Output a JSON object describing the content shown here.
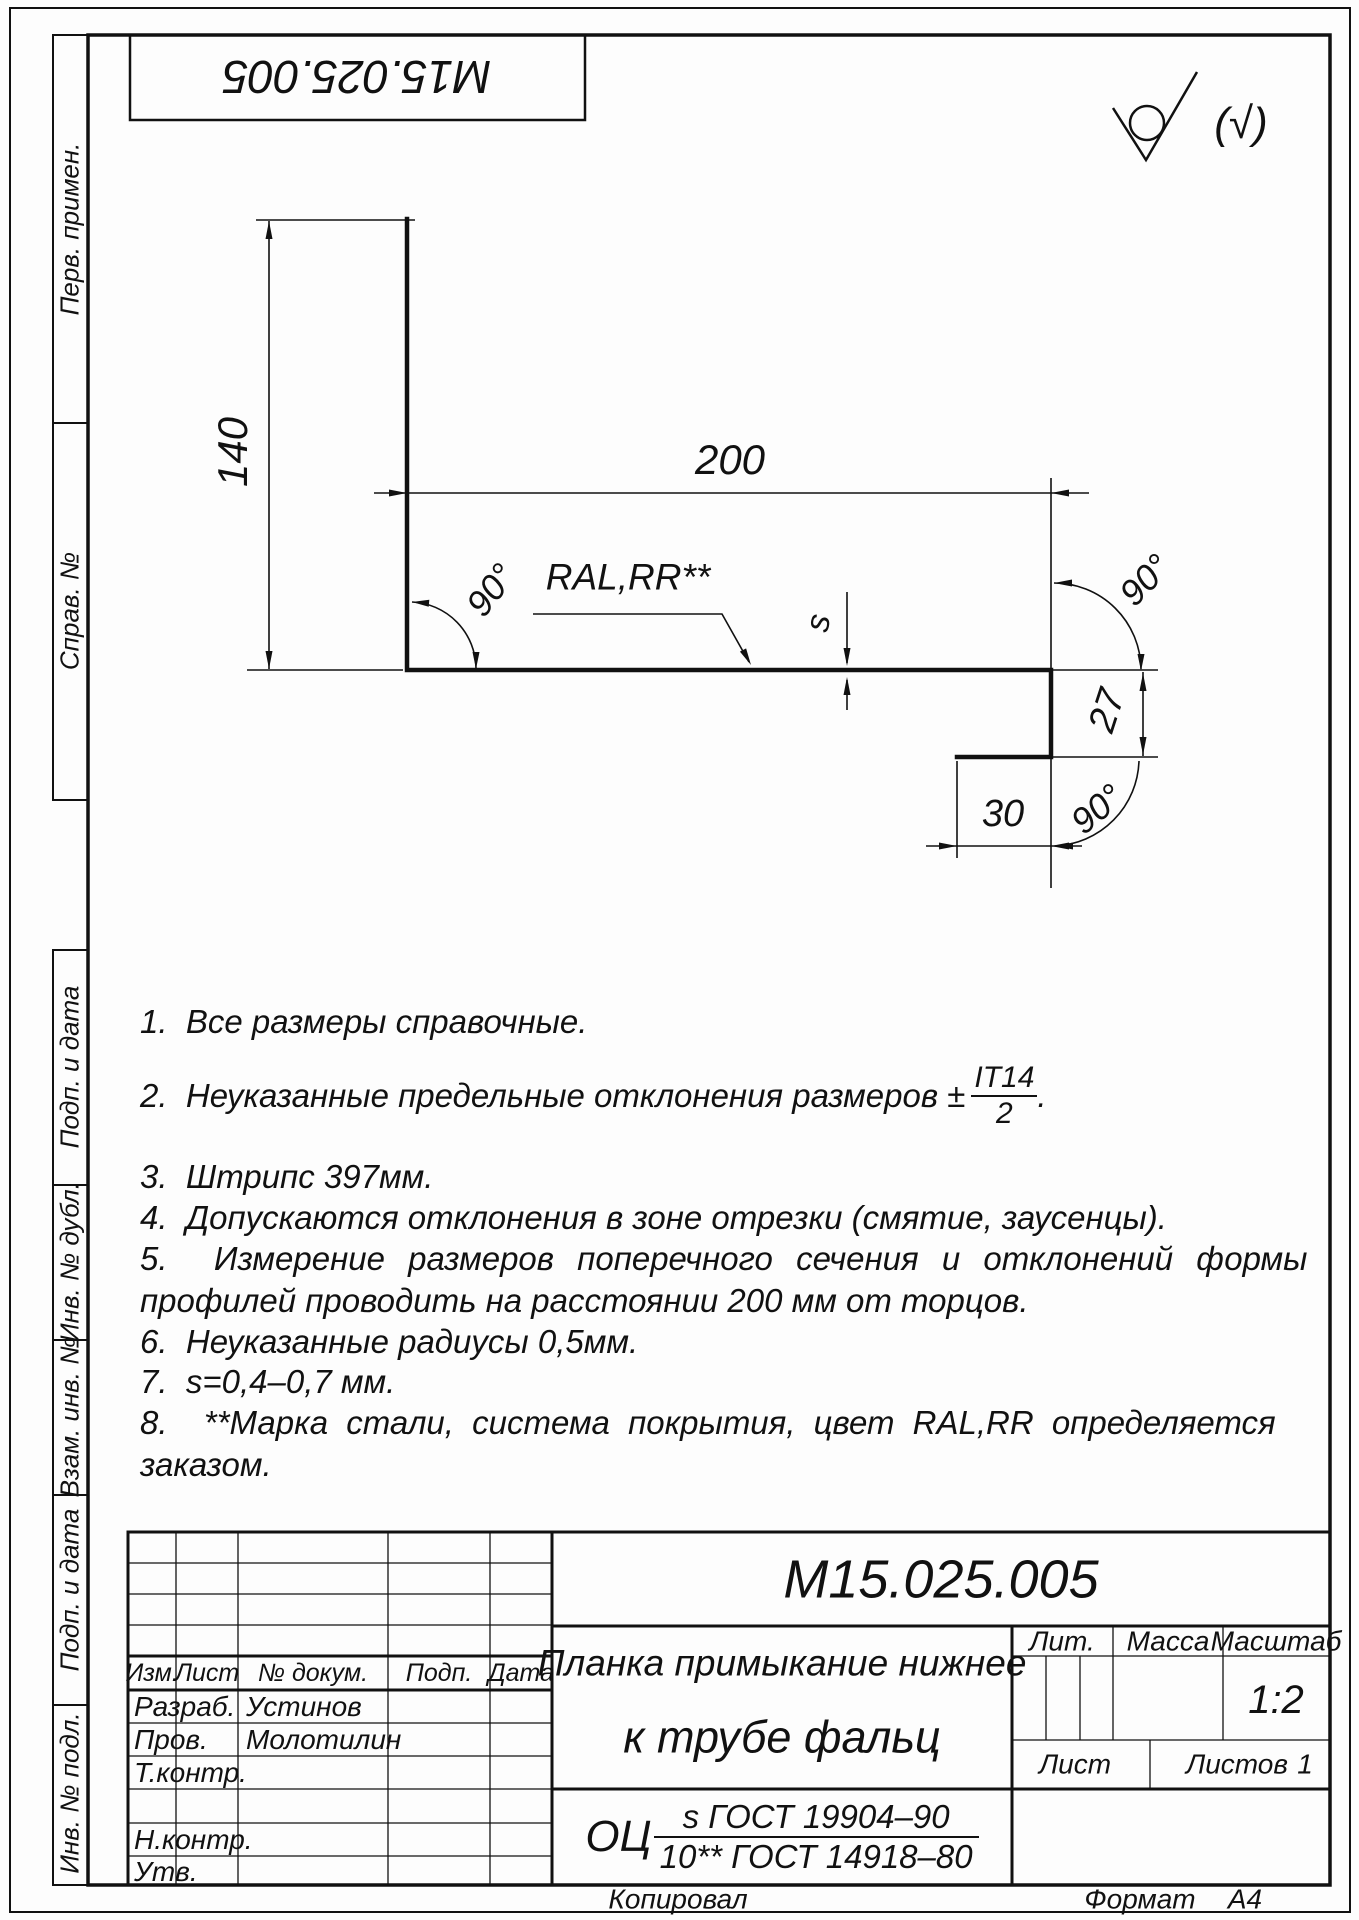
{
  "page": {
    "drawing_number": "M15.025.005",
    "roughness_mark": "(√)",
    "kopiroval": "Копировал",
    "format_label": "Формат",
    "format_value": "А4"
  },
  "dims": {
    "height": "140",
    "width": "200",
    "coating": "RAL,RR**",
    "angle_left": "90°",
    "angle_top_right": "90°",
    "angle_bottom_right": "90°",
    "thickness": "s",
    "lip": "27",
    "hem": "30"
  },
  "notes": {
    "n1": "1.  Все размеры справочные.",
    "n2_prefix": "2.  Неуказанные предельные отклонения размеров ±",
    "n2_num": "IT14",
    "n2_den": "2",
    "n2_suffix": ".",
    "n3": "3.  Штрипс 397мм.",
    "n4": "4.  Допускаются отклонения в зоне отрезки (смятие, заусенцы).",
    "n5_line1": "5.  Измерение размеров поперечного сечения и отклонений формы",
    "n5_line2": "профилей проводить на расстоянии 200 мм от торцов.",
    "n6": "6.  Неуказанные радиусы 0,5мм.",
    "n7": "7.  s=0,4–0,7 мм.",
    "n8_line1": "8.  **Марка стали, система покрытия, цвет RAL,RR определяется",
    "n8_line2": "заказом."
  },
  "title_block": {
    "designation": "M15.025.005",
    "name_line1": "Планка примыкание нижнее",
    "name_line2": "к трубе фальц",
    "material_prefix": "ОЦ",
    "material_numerator": "s ГОСТ 19904–90",
    "material_denominator": "10** ГОСТ 14918–80",
    "col_izm": "Изм.",
    "col_list": "Лист",
    "col_doc": "№ докум.",
    "col_podp": "Подп.",
    "col_data": "Дата",
    "razrab_label": "Разраб.",
    "razrab_value": "Устинов",
    "prov_label": "Пров.",
    "prov_value": "Молотилин",
    "tkontr_label": "Т.контр.",
    "nkontr_label": "Н.контр.",
    "utv_label": "Утв.",
    "lit_label": "Лит.",
    "massa_label": "Масса",
    "masshtab_label": "Масштаб",
    "scale": "1:2",
    "list_label": "Лист",
    "listov_label": "Листов",
    "listov_value": "1"
  },
  "side_stamps": {
    "perv_primen": "Перв. примен.",
    "sprav_no": "Справ. №",
    "podp_i_data_1": "Подп. и дата",
    "inv_no_dubl": "Инв. № дубл.",
    "vzam_inv_no": "Взам. инв. №",
    "podp_i_data_2": "Подп. и дата",
    "inv_no_podl": "Инв. № подл."
  }
}
